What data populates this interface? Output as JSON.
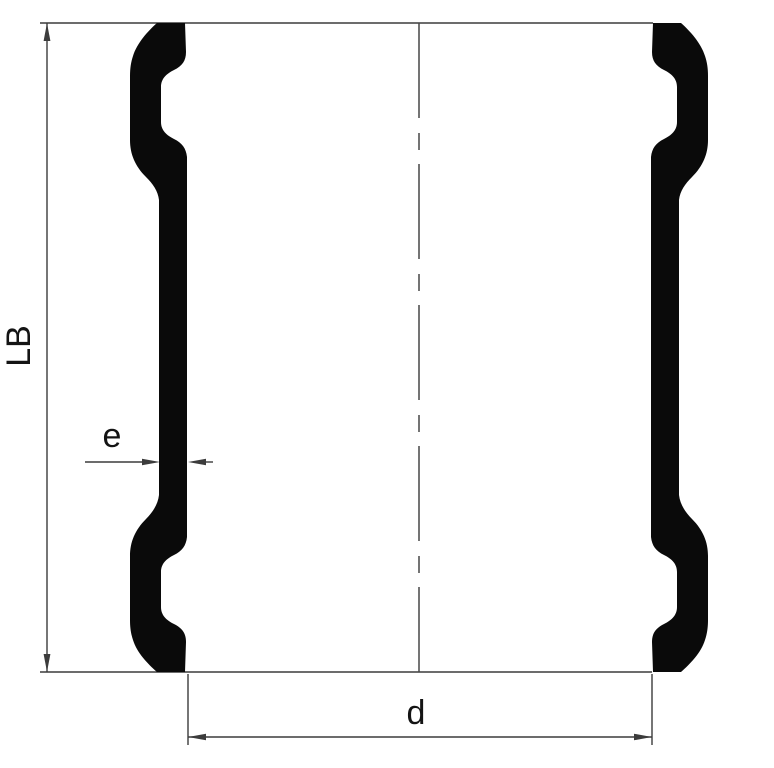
{
  "labels": {
    "overall_length": "LB",
    "wall_thickness": "e",
    "inner_diameter": "d"
  },
  "colors": {
    "background": "#ffffff",
    "profile_fill": "#0a0a0a",
    "dimension_line": "#3c3c3c",
    "centerline": "#474747",
    "text": "#141414"
  }
}
